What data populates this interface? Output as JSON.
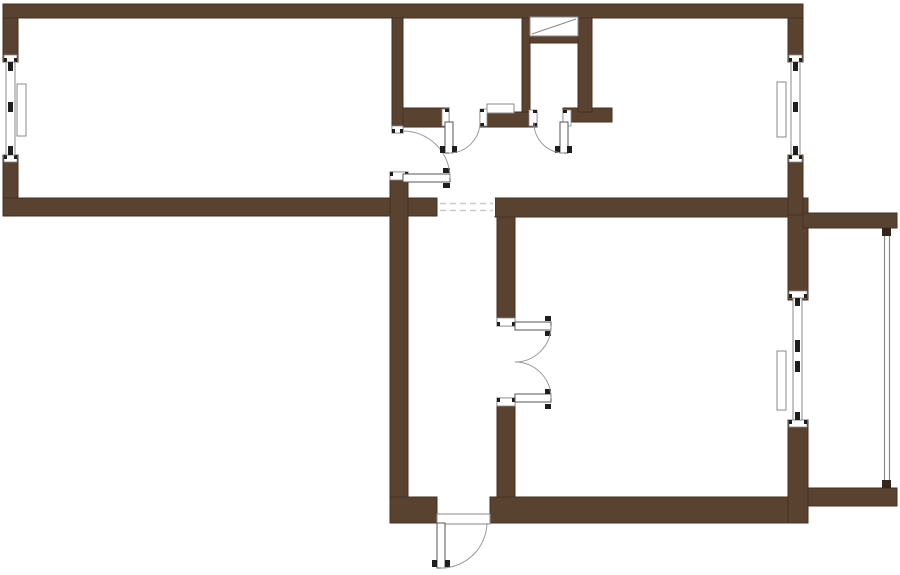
{
  "meta": {
    "canvas": {
      "w": 900,
      "h": 575
    },
    "drawing_kind": "apartment-floor-plan"
  },
  "colors": {
    "background": "#ffffff",
    "wall_fill": "#5a4231",
    "wall_stroke": "#443224",
    "frame_gray": "#8a8a8a",
    "arc_gray": "#9a9a9a",
    "dark_tick": "#1e1e1e",
    "dash_gray": "#c9c9c9",
    "post_fill": "#33261b",
    "white": "#ffffff"
  },
  "plan": {
    "walls": [
      {
        "id": "top-wall",
        "x": 3,
        "y": 4,
        "w": 800,
        "h": 14
      },
      {
        "id": "left-wall-upper",
        "x": 3,
        "y": 18,
        "w": 15,
        "h": 44
      },
      {
        "id": "left-wall-lower",
        "x": 3,
        "y": 155,
        "w": 15,
        "h": 61
      },
      {
        "id": "mid-wall-left",
        "x": 3,
        "y": 198,
        "w": 434,
        "h": 18
      },
      {
        "id": "living-partition",
        "x": 392,
        "y": 18,
        "w": 11,
        "h": 115
      },
      {
        "id": "corridor-west-wall",
        "x": 390,
        "y": 172,
        "w": 18,
        "h": 351
      },
      {
        "id": "entry-left-block",
        "x": 390,
        "y": 497,
        "w": 47,
        "h": 26
      },
      {
        "id": "bath-south-west",
        "x": 403,
        "y": 108,
        "w": 46,
        "h": 19
      },
      {
        "id": "bath-south-mid",
        "x": 480,
        "y": 112,
        "w": 57,
        "h": 15
      },
      {
        "id": "wc-south-east",
        "x": 563,
        "y": 108,
        "w": 49,
        "h": 14
      },
      {
        "id": "bath-wc-partition",
        "x": 522,
        "y": 18,
        "w": 8,
        "h": 94
      },
      {
        "id": "wc-east-wall",
        "x": 578,
        "y": 18,
        "w": 14,
        "h": 94
      },
      {
        "id": "vent-shelf-wall",
        "x": 530,
        "y": 36,
        "w": 48,
        "h": 7
      },
      {
        "id": "mid-wall-right",
        "x": 495,
        "y": 198,
        "w": 313,
        "h": 19
      },
      {
        "id": "room-west-upper",
        "x": 497,
        "y": 217,
        "w": 18,
        "h": 109
      },
      {
        "id": "room-west-lower",
        "x": 497,
        "y": 398,
        "w": 18,
        "h": 125
      },
      {
        "id": "bottom-wall",
        "x": 490,
        "y": 497,
        "w": 318,
        "h": 26
      },
      {
        "id": "right-wall-upper",
        "x": 788,
        "y": 18,
        "w": 15,
        "h": 44
      },
      {
        "id": "right-wall-mid-a",
        "x": 788,
        "y": 155,
        "w": 15,
        "h": 62
      },
      {
        "id": "right-wall-mid-b",
        "x": 788,
        "y": 215,
        "w": 20,
        "h": 85
      },
      {
        "id": "right-wall-lower",
        "x": 788,
        "y": 420,
        "w": 20,
        "h": 103
      },
      {
        "id": "balcony-top-bar",
        "x": 803,
        "y": 213,
        "w": 94,
        "h": 15
      },
      {
        "id": "balcony-bottom-bar",
        "x": 808,
        "y": 488,
        "w": 89,
        "h": 18
      }
    ],
    "jambs": [
      {
        "id": "door1-jamb-top",
        "x": 392,
        "y": 126,
        "w": 11,
        "h": 7,
        "side": "bottom"
      },
      {
        "id": "door1-jamb-bottom",
        "x": 390,
        "y": 172,
        "w": 18,
        "h": 8,
        "side": "top"
      },
      {
        "id": "bath-jamb-left",
        "x": 442,
        "y": 109,
        "w": 7,
        "h": 17,
        "side": "right"
      },
      {
        "id": "bath-jamb-right",
        "x": 480,
        "y": 109,
        "w": 7,
        "h": 17,
        "side": "left"
      },
      {
        "id": "wc-jamb-left",
        "x": 529,
        "y": 110,
        "w": 8,
        "h": 16,
        "side": "right"
      },
      {
        "id": "wc-jamb-right",
        "x": 563,
        "y": 110,
        "w": 8,
        "h": 16,
        "side": "left"
      },
      {
        "id": "ddoor-jamb-top",
        "x": 497,
        "y": 318,
        "w": 18,
        "h": 8,
        "side": "bottom"
      },
      {
        "id": "ddoor-jamb-bottom",
        "x": 497,
        "y": 398,
        "w": 18,
        "h": 8,
        "side": "top"
      },
      {
        "id": "win1-jamb-top",
        "x": 4,
        "y": 55,
        "w": 13,
        "h": 7,
        "side": "bottom"
      },
      {
        "id": "win1-jamb-bottom",
        "x": 4,
        "y": 155,
        "w": 13,
        "h": 7,
        "side": "top"
      },
      {
        "id": "win2-jamb-top",
        "x": 789,
        "y": 55,
        "w": 13,
        "h": 7,
        "side": "bottom"
      },
      {
        "id": "win2-jamb-bottom",
        "x": 789,
        "y": 155,
        "w": 13,
        "h": 7,
        "side": "top"
      },
      {
        "id": "win3-jamb-top",
        "x": 789,
        "y": 291,
        "w": 18,
        "h": 7,
        "side": "bottom"
      },
      {
        "id": "win3-jamb-bottom",
        "x": 789,
        "y": 420,
        "w": 18,
        "h": 7,
        "side": "top"
      }
    ],
    "windows": [
      {
        "id": "window-left",
        "frame": {
          "x": 6,
          "y": 62,
          "w": 9,
          "h": 93
        },
        "blocks": [
          {
            "x": 8,
            "y": 62,
            "w": 5,
            "h": 9
          },
          {
            "x": 8,
            "y": 102,
            "w": 5,
            "h": 10
          },
          {
            "x": 8,
            "y": 146,
            "w": 5,
            "h": 9
          }
        ],
        "sill": {
          "x": 17,
          "y": 84,
          "w": 9,
          "h": 52
        }
      },
      {
        "id": "window-right",
        "frame": {
          "x": 791,
          "y": 62,
          "w": 9,
          "h": 93
        },
        "blocks": [
          {
            "x": 793,
            "y": 62,
            "w": 5,
            "h": 9
          },
          {
            "x": 793,
            "y": 102,
            "w": 5,
            "h": 10
          },
          {
            "x": 793,
            "y": 146,
            "w": 5,
            "h": 9
          }
        ],
        "sill": {
          "x": 777,
          "y": 82,
          "w": 9,
          "h": 55
        }
      },
      {
        "id": "balcony-door-window",
        "frame": {
          "x": 793,
          "y": 298,
          "w": 9,
          "h": 122
        },
        "blocks": [
          {
            "x": 795,
            "y": 298,
            "w": 5,
            "h": 8
          },
          {
            "x": 795,
            "y": 340,
            "w": 5,
            "h": 12
          },
          {
            "x": 795,
            "y": 361,
            "w": 5,
            "h": 11
          },
          {
            "x": 795,
            "y": 412,
            "w": 5,
            "h": 8
          }
        ],
        "sill": {
          "x": 777,
          "y": 351,
          "w": 9,
          "h": 59
        }
      }
    ],
    "doors": [
      {
        "id": "living-room-door",
        "leaf": {
          "x": 403,
          "y": 174,
          "w": 47,
          "h": 8
        },
        "ticks": [
          {
            "x": 443,
            "y": 168,
            "w": 7,
            "h": 5
          },
          {
            "x": 443,
            "y": 183,
            "w": 7,
            "h": 5
          }
        ],
        "arc": "M 450 178 A 47 47 0 0 0 403 131"
      },
      {
        "id": "bathroom-door",
        "leaf": {
          "x": 445,
          "y": 122,
          "w": 8,
          "h": 31
        },
        "ticks": [
          {
            "x": 440,
            "y": 146,
            "w": 5,
            "h": 7
          },
          {
            "x": 452,
            "y": 146,
            "w": 5,
            "h": 7
          }
        ],
        "arc": "M 449 153 A 31 31 0 0 0 480 122"
      },
      {
        "id": "wc-door",
        "leaf": {
          "x": 560,
          "y": 122,
          "w": 8,
          "h": 31
        },
        "ticks": [
          {
            "x": 555,
            "y": 146,
            "w": 5,
            "h": 7
          },
          {
            "x": 567,
            "y": 146,
            "w": 5,
            "h": 7
          }
        ],
        "arc": "M 564 153 A 30 30 0 0 1 534 122"
      },
      {
        "id": "double-door-top-leaf",
        "leaf": {
          "x": 515,
          "y": 322,
          "w": 36,
          "h": 8
        },
        "ticks": [
          {
            "x": 545,
            "y": 316,
            "w": 6,
            "h": 5
          },
          {
            "x": 545,
            "y": 331,
            "w": 6,
            "h": 5
          }
        ],
        "arc": "M 551 326 A 36 36 0 0 1 515 362"
      },
      {
        "id": "double-door-bottom-leaf",
        "leaf": {
          "x": 515,
          "y": 394,
          "w": 36,
          "h": 8
        },
        "ticks": [
          {
            "x": 545,
            "y": 389,
            "w": 6,
            "h": 5
          },
          {
            "x": 545,
            "y": 404,
            "w": 6,
            "h": 5
          }
        ],
        "arc": "M 551 398 A 36 36 0 0 0 515 362"
      },
      {
        "id": "entrance-door",
        "leaf": {
          "x": 437,
          "y": 523,
          "w": 8,
          "h": 45
        },
        "ticks": [
          {
            "x": 432,
            "y": 560,
            "w": 5,
            "h": 7
          },
          {
            "x": 445,
            "y": 560,
            "w": 5,
            "h": 7
          }
        ],
        "arc": "M 441 568 A 46 46 0 0 0 487 523"
      }
    ],
    "threshold": {
      "x": 437,
      "y": 514,
      "w": 53,
      "h": 10
    },
    "dashed_opening": {
      "x": 438,
      "y": 198,
      "w": 57,
      "h": 18,
      "line_ys": [
        203.5,
        210.5
      ]
    },
    "vent_box": {
      "x": 530,
      "y": 17,
      "w": 48,
      "h": 19,
      "diagonal": "M 532 34 L 576 19"
    },
    "shelf": {
      "x": 487,
      "y": 104,
      "w": 27,
      "h": 9
    },
    "railing": {
      "x1": 884.5,
      "x2": 889.5,
      "y_top": 234,
      "y_bottom": 482,
      "posts": [
        {
          "x": 882,
          "y": 228,
          "w": 9,
          "h": 8
        },
        {
          "x": 882,
          "y": 480,
          "w": 9,
          "h": 8
        }
      ]
    }
  }
}
